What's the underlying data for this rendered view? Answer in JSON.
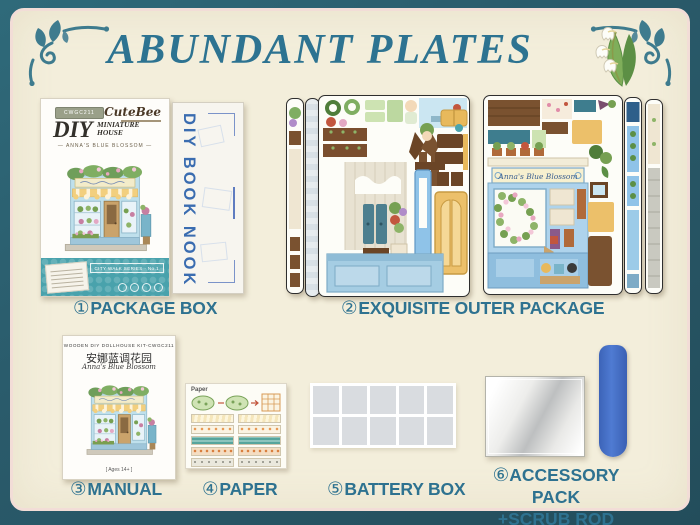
{
  "title": "ABUNDANT PLATES",
  "shop_sign": "Anna's Blue Blossom",
  "items": [
    {
      "num": "①",
      "text": "PACKAGE BOX"
    },
    {
      "num": "②",
      "text": "EXQUISITE OUTER PACKAGE"
    },
    {
      "num": "③",
      "text": "MANUAL"
    },
    {
      "num": "④",
      "text": "PAPER"
    },
    {
      "num": "⑤",
      "text": "BATTERY BOX"
    },
    {
      "num": "⑥",
      "text": "ACCESSORY PACK",
      "text2": "+SCRUB ROD"
    }
  ],
  "package_box": {
    "badge": "CWGC211",
    "brand": "CuteBee",
    "product_title": "DIY",
    "product_sub1": "MINIATURE",
    "product_sub2": "HOUSE",
    "subtitle": "— ANNA'S BLUE BLOSSOM —",
    "series": "CITY WALK SERIES · No.1"
  },
  "spine": {
    "text": "DIY BOOK NOOK"
  },
  "manual": {
    "kit_line": "WOODEN DIY DOLLHOUSE KIT-CWGC211",
    "title_cn": "安娜蓝调花园",
    "title_en": "Anna's Blue Blossom",
    "age_line": "[ Ages 14+ ]"
  },
  "paper": {
    "sheet_label": "Paper"
  },
  "colors": {
    "accent_teal": "#2e7290",
    "frame_teal": "#2a5b6b",
    "card_cream": "#f3eedb",
    "scrub_rod_blue": "#4470c8"
  }
}
